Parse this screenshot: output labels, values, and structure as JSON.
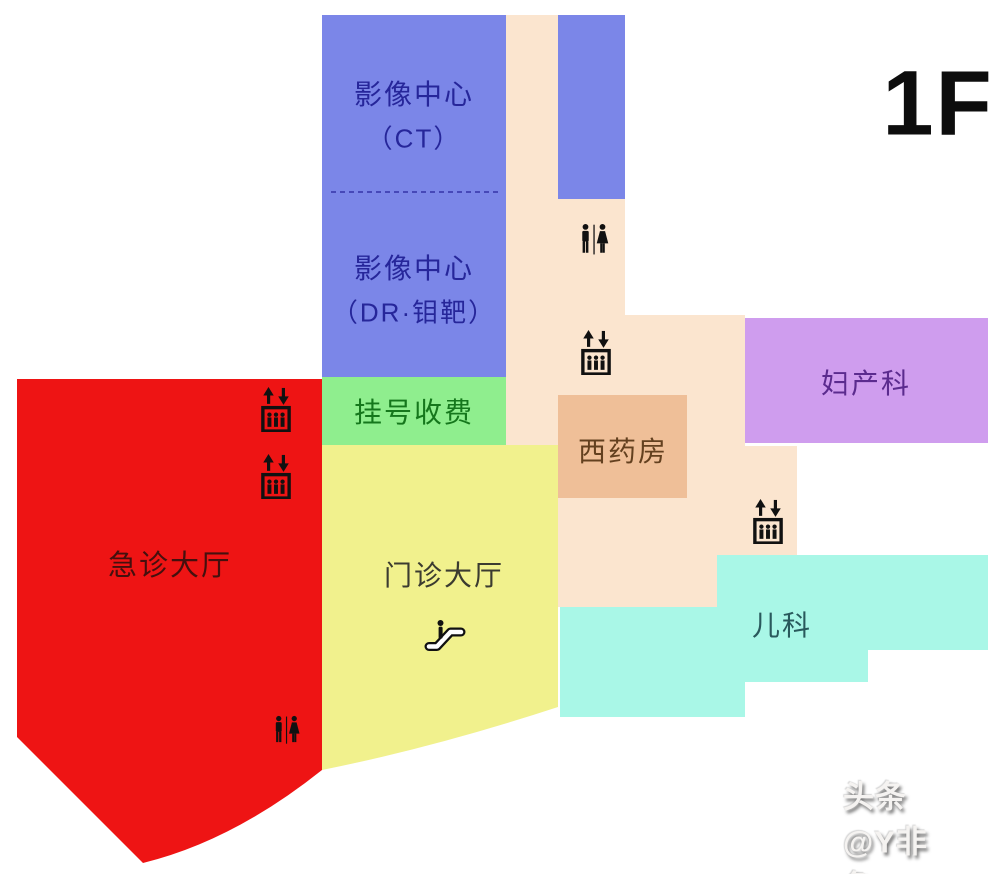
{
  "floor_label": "1F",
  "watermark": "头条@Y非鱼Y",
  "colors": {
    "background": "#ffffff",
    "corridor": "#fbe5cf",
    "imaging_block": "#7b86e8",
    "annex_block": "#7b86e8",
    "registration_block": "#8fee8e",
    "emergency_block": "#ee1414",
    "outpatient_block": "#f1f18d",
    "pharmacy_block": "#efbf98",
    "obstetrics_block": "#cf9dee",
    "pediatrics_block": "#a9f7e7",
    "divider_line": "#3434a8",
    "icon_black": "#111111"
  },
  "rooms": {
    "imaging_ct": {
      "line1": "影像中心",
      "line2": "（CT）",
      "text_color": "#26269a"
    },
    "imaging_dr": {
      "line1": "影像中心",
      "line2": "（DR·钼靶）",
      "text_color": "#26269a"
    },
    "registration": {
      "name": "挂号收费",
      "text_color": "#15771c"
    },
    "emergency": {
      "name": "急诊大厅",
      "text_color": "#44100e"
    },
    "outpatient": {
      "name": "门诊大厅",
      "text_color": "#3b3b30"
    },
    "pharmacy": {
      "name": "西药房",
      "text_color": "#63401f"
    },
    "obstetrics": {
      "name": "妇产科",
      "text_color": "#5b2b8e"
    },
    "pediatrics": {
      "name": "儿科",
      "text_color": "#29595c"
    }
  },
  "icons": {
    "restroom": "restroom-icon",
    "elevator": "elevator-icon",
    "escalator": "escalator-icon"
  }
}
